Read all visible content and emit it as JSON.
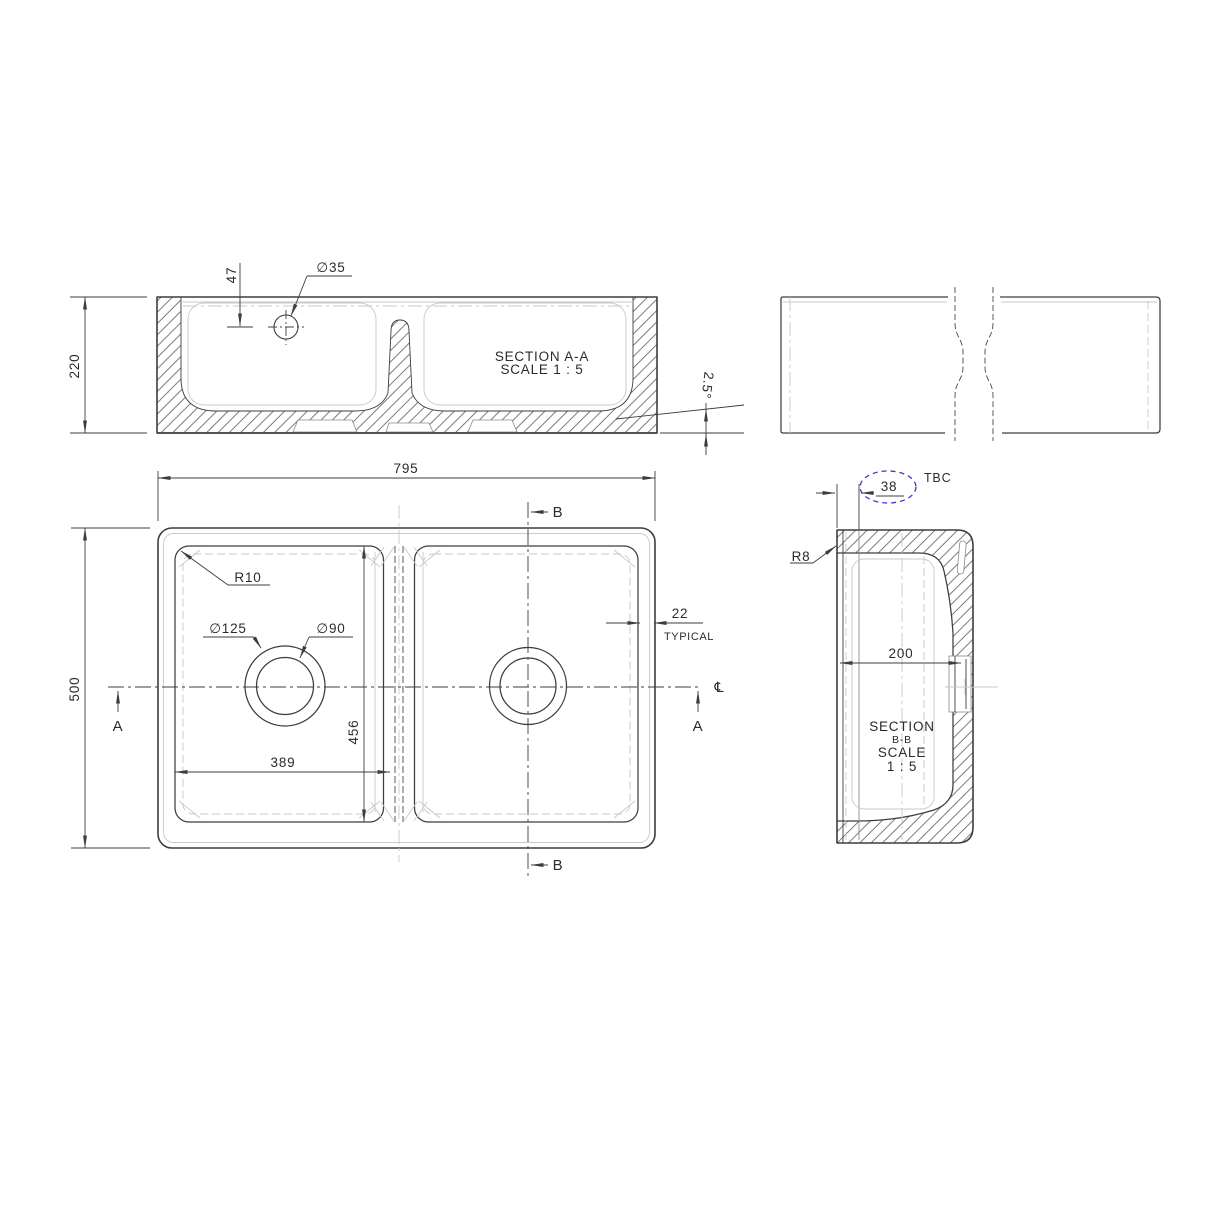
{
  "title": "Double bowl sink technical drawing",
  "colors": {
    "line": "#3d3d3d",
    "ghost": "#c9c9c9",
    "highlight_blue": "#3a3ad0"
  },
  "section_aa": {
    "title": "SECTION A-A",
    "scale": "SCALE 1 : 5"
  },
  "section_bb": {
    "title": "SECTION",
    "subtitle": "B-B",
    "scale_word": "SCALE",
    "scale_ratio": "1 : 5"
  },
  "dims": {
    "height": "220",
    "tap_offset": "47",
    "tap_dia": "∅35",
    "draft": "2.5°",
    "length": "795",
    "width": "500",
    "radius_plan": "R10",
    "waste_outer": "∅125",
    "waste_inner": "∅90",
    "bowl_len": "389",
    "bowl_wid": "456",
    "wall": "22",
    "wall_note": "TYPICAL",
    "rim": "38",
    "rim_note": "TBC",
    "radius_section": "R8",
    "half_width": "200"
  },
  "markers": {
    "a": "A",
    "b": "B",
    "cl": "℄"
  }
}
